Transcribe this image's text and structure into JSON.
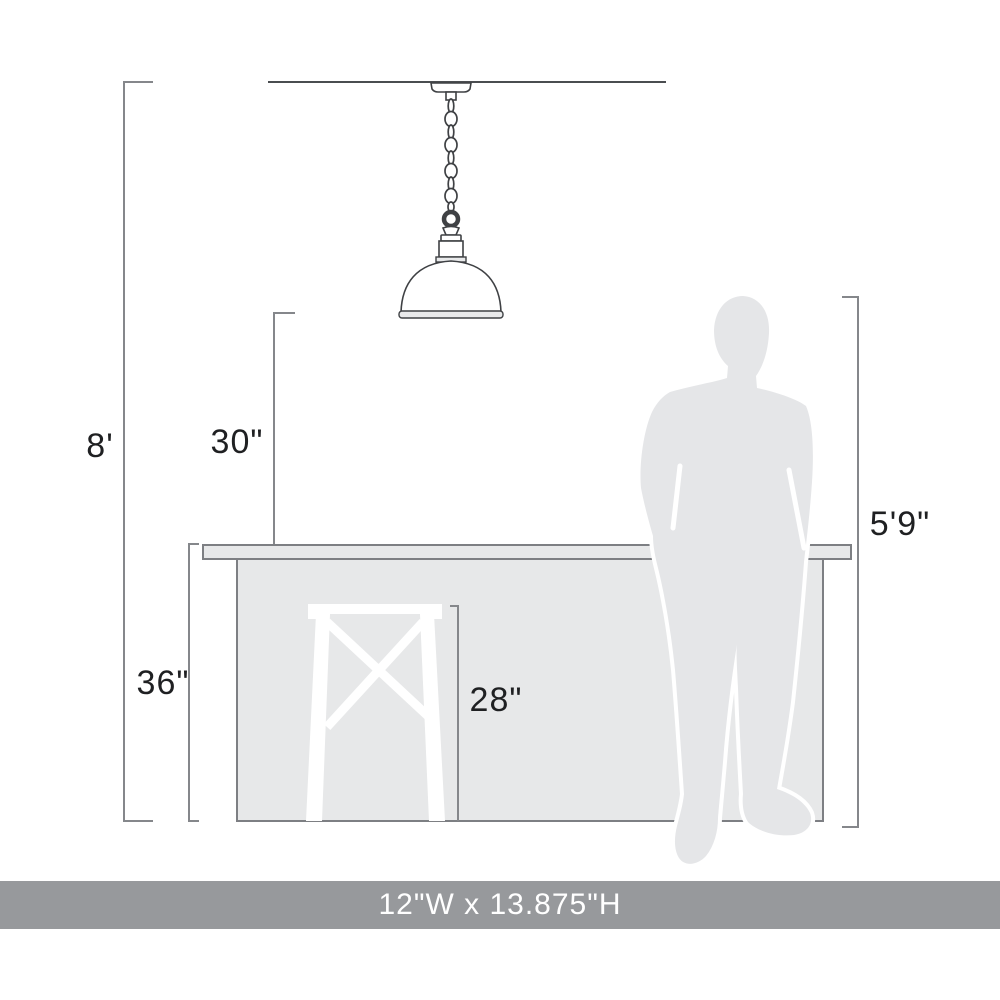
{
  "dimensions": {
    "ceiling_height": "8'",
    "pendant_clearance_above_counter": "30\"",
    "counter_height": "36\"",
    "stool_height": "28\"",
    "person_height": "5'9\""
  },
  "footer": {
    "fixture_size": "12\"W x 13.875\"H"
  },
  "objects": [
    "pendant-light-fixture",
    "ceiling-line",
    "kitchen-island-counter",
    "bar-stool",
    "person-silhouette"
  ],
  "colors": {
    "dimension_line": "#85878b",
    "ceiling_line": "#4a4d50",
    "counter_fill": "#e7e8e9",
    "counter_outline": "#7d7f83",
    "silhouette_fill": "#e5e6e8",
    "fixture_outline": "#3f4144",
    "banner": "#97999c",
    "label_text": "#1f2022"
  }
}
